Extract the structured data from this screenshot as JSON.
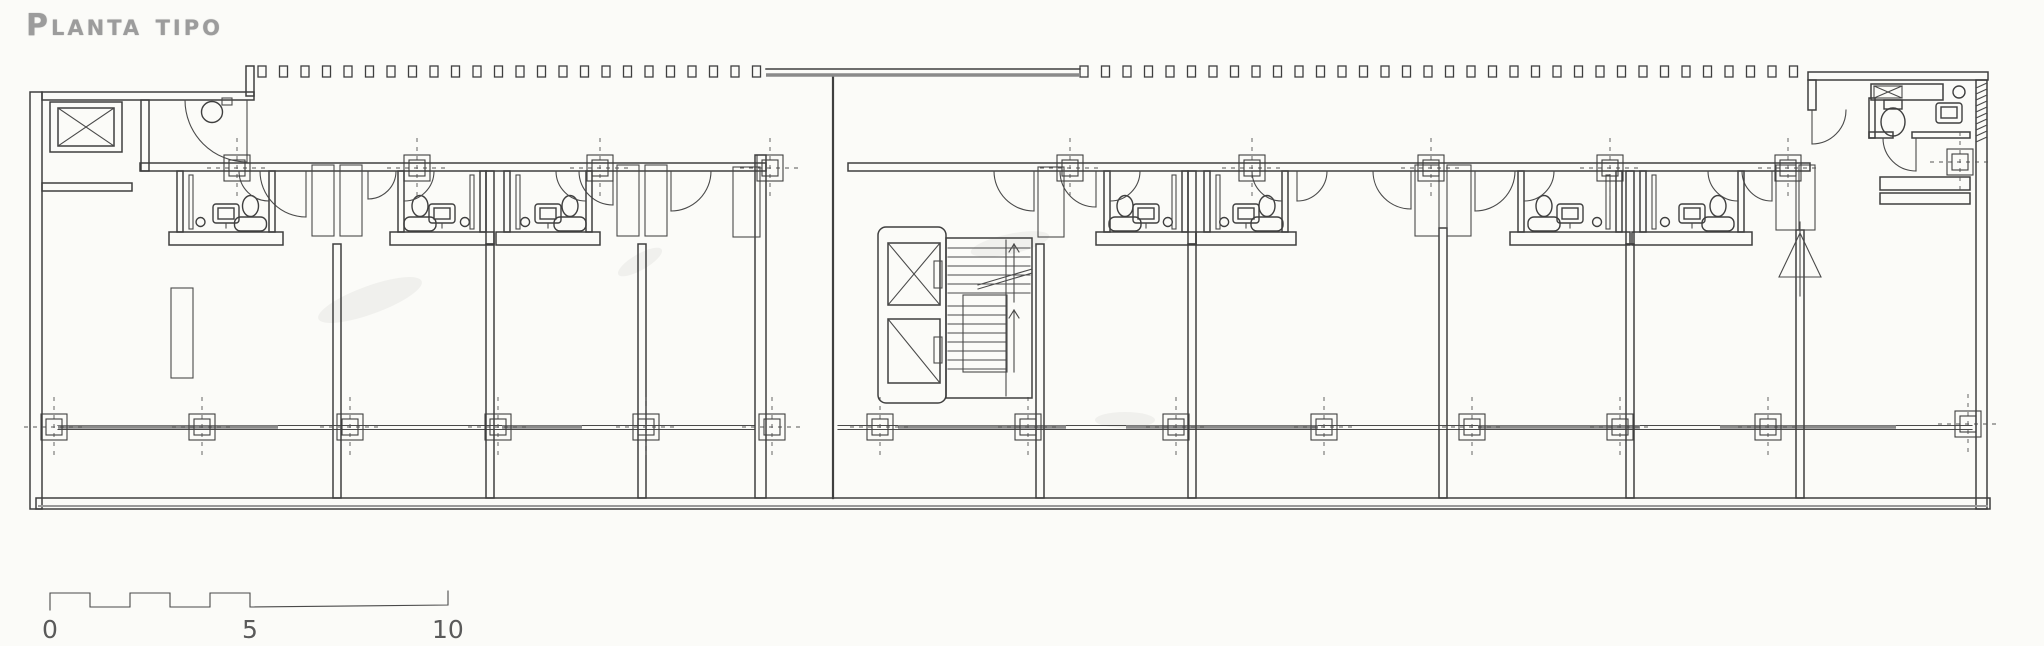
{
  "title": {
    "text": "Planta tipo"
  },
  "scale_bar": {
    "labels": [
      {
        "t": "0",
        "x": 42
      },
      {
        "t": "5",
        "x": 242
      },
      {
        "t": "10",
        "x": 432
      }
    ],
    "x0": 50,
    "unit": 40,
    "x5": 250,
    "x10": 448,
    "y_hi": 593,
    "y_lo": 607,
    "label_y": 638
  },
  "drawing": {
    "ink": "#3f3f3f",
    "paper": "#fbfbf8",
    "title_color": "#9c9c9c",
    "strip_y": 66,
    "strip_h": 11,
    "strip_w": 8,
    "strip_pitch": 21.5,
    "strips": [
      [
        258,
        764
      ],
      [
        1080,
        1806
      ]
    ],
    "top_band": {
      "x1": 766,
      "x2": 1080,
      "y1": 69,
      "y2": 75
    },
    "walls": [
      [
        30,
        92,
        12,
        417
      ],
      [
        42,
        92,
        212,
        8
      ],
      [
        246,
        66,
        8,
        30
      ],
      [
        42,
        183,
        90,
        8
      ],
      [
        141,
        100,
        8,
        71
      ],
      [
        140,
        163,
        626,
        8
      ],
      [
        333,
        244,
        8,
        254
      ],
      [
        486,
        171,
        8,
        73
      ],
      [
        486,
        244,
        8,
        254
      ],
      [
        638,
        244,
        8,
        254
      ],
      [
        755,
        155,
        11,
        343
      ],
      [
        848,
        163,
        962,
        8
      ],
      [
        1036,
        244,
        8,
        254
      ],
      [
        1188,
        171,
        8,
        73
      ],
      [
        1188,
        244,
        8,
        254
      ],
      [
        1439,
        228,
        8,
        270
      ],
      [
        1626,
        171,
        8,
        73
      ],
      [
        1626,
        244,
        8,
        254
      ],
      [
        1796,
        230,
        8,
        268
      ],
      [
        1808,
        72,
        180,
        8
      ],
      [
        1976,
        80,
        11,
        429
      ],
      [
        1808,
        80,
        8,
        30
      ],
      [
        1869,
        98,
        6,
        40
      ],
      [
        1869,
        132,
        24,
        6
      ],
      [
        1912,
        132,
        58,
        6
      ],
      [
        1871,
        84,
        72,
        16
      ],
      [
        1880,
        177,
        90,
        13
      ],
      [
        1880,
        193,
        90,
        11
      ],
      [
        36,
        498,
        1954,
        11
      ]
    ],
    "bottom_gray": [
      38,
      506,
      1988,
      506
    ],
    "edge_line": [
      833,
      75,
      833,
      498
    ],
    "shafts": [
      [
        312,
        165,
        22,
        71
      ],
      [
        340,
        165,
        22,
        71
      ],
      [
        617,
        165,
        22,
        71
      ],
      [
        645,
        165,
        22,
        71
      ],
      [
        1038,
        167,
        26,
        70
      ],
      [
        1415,
        165,
        24,
        71
      ],
      [
        1447,
        165,
        24,
        71
      ],
      [
        1776,
        165,
        20,
        65
      ],
      [
        1799,
        165,
        16,
        65
      ],
      [
        733,
        167,
        27,
        70
      ],
      [
        171,
        288,
        22,
        90
      ],
      [
        222,
        98,
        10,
        7
      ]
    ],
    "arcs": [
      [
        247,
        100,
        62,
        "SW"
      ],
      [
        306,
        171,
        46,
        "SW"
      ],
      [
        368,
        171,
        28,
        "SE"
      ],
      [
        613,
        171,
        34,
        "SW"
      ],
      [
        671,
        171,
        40,
        "SE"
      ],
      [
        1034,
        171,
        40,
        "SW"
      ],
      [
        1096,
        171,
        36,
        "SW"
      ],
      [
        1297,
        171,
        30,
        "SE"
      ],
      [
        1411,
        171,
        38,
        "SW"
      ],
      [
        1475,
        171,
        40,
        "SE"
      ],
      [
        1772,
        171,
        30,
        "SW"
      ],
      [
        1812,
        110,
        34,
        "SE"
      ],
      [
        1916,
        138,
        33,
        "SW"
      ]
    ],
    "pods": [
      {
        "x": 177,
        "w": 98,
        "flip": false
      },
      {
        "x": 398,
        "w": 88,
        "flip": true
      },
      {
        "x": 504,
        "w": 88,
        "flip": false
      },
      {
        "x": 1104,
        "w": 84,
        "flip": true
      },
      {
        "x": 1204,
        "w": 84,
        "flip": false
      },
      {
        "x": 1518,
        "w": 104,
        "flip": true
      },
      {
        "x": 1640,
        "w": 104,
        "flip": false
      }
    ],
    "markers": [
      [
        237,
        168
      ],
      [
        417,
        168
      ],
      [
        600,
        168
      ],
      [
        770,
        168
      ],
      [
        1070,
        168
      ],
      [
        1252,
        168
      ],
      [
        1431,
        168
      ],
      [
        1610,
        168
      ],
      [
        1788,
        168
      ],
      [
        1960,
        162
      ],
      [
        54,
        427
      ],
      [
        202,
        427
      ],
      [
        350,
        427
      ],
      [
        498,
        427
      ],
      [
        646,
        427
      ],
      [
        772,
        427
      ],
      [
        880,
        427
      ],
      [
        1028,
        427
      ],
      [
        1176,
        427
      ],
      [
        1324,
        427
      ],
      [
        1472,
        427
      ],
      [
        1620,
        427
      ],
      [
        1768,
        427
      ],
      [
        1968,
        424
      ]
    ],
    "rails": {
      "y": 427,
      "spans": [
        [
          58,
          754
        ],
        [
          838,
          1972
        ]
      ],
      "thick": [
        [
          58,
          278
        ],
        [
          502,
          582
        ],
        [
          898,
          1066
        ],
        [
          1126,
          1318
        ],
        [
          1478,
          1640
        ],
        [
          1720,
          1896
        ]
      ]
    },
    "left_elevator": {
      "outer": [
        50,
        102,
        72,
        50
      ],
      "inner": [
        58,
        108,
        56,
        38
      ]
    },
    "core": {
      "outer": [
        878,
        227,
        68,
        176
      ],
      "cab1": {
        "box": [
          888,
          243,
          52,
          62
        ],
        "door": [
          934,
          261,
          8,
          27
        ],
        "cross": "X"
      },
      "cab2": {
        "box": [
          888,
          319,
          52,
          64
        ],
        "door": [
          934,
          337,
          8,
          26
        ],
        "cross": "/"
      }
    },
    "stair": {
      "box": [
        946,
        238,
        86,
        160
      ],
      "hi": {
        "x1": 948,
        "x2": 1030,
        "y0": 248,
        "dy": 9,
        "n": 6
      },
      "lo": {
        "x1": 948,
        "x2": 1006,
        "y0": 306,
        "dy": 9,
        "n": 8
      },
      "landing": [
        963,
        295,
        44,
        77
      ],
      "rail": [
        1006,
        240,
        1006,
        396
      ],
      "arrows": [
        [
          1014,
          302,
          1014,
          244
        ],
        [
          1014,
          372,
          1014,
          310
        ]
      ],
      "breaks": [
        [
          978,
          289,
          1032,
          273
        ],
        [
          978,
          285,
          1032,
          269
        ]
      ]
    },
    "end_unit": {
      "xbox": [
        1874,
        86,
        28,
        12
      ],
      "toilet_ellipse": [
        1893,
        122,
        12,
        14
      ],
      "toilet_tank": [
        1884,
        100,
        18,
        9
      ],
      "sink_box": [
        1936,
        103,
        26,
        20
      ],
      "sink_inner": [
        1941,
        107,
        16,
        11
      ],
      "vent_circle": [
        1959,
        92,
        6
      ],
      "hatch": [
        1976,
        83,
        11,
        58
      ],
      "cone": {
        "tip": [
          1800,
          233
        ],
        "base": [
          1779,
          277,
          1821,
          277
        ],
        "line": [
          1800,
          222,
          1800,
          296
        ]
      }
    },
    "circles": [
      [
        212,
        112,
        10.5
      ]
    ],
    "smudges": [
      [
        370,
        300,
        55,
        14,
        -20
      ],
      [
        1010,
        244,
        40,
        10,
        -12
      ],
      [
        1125,
        420,
        30,
        8,
        0
      ],
      [
        640,
        262,
        25,
        8,
        -30
      ]
    ]
  }
}
